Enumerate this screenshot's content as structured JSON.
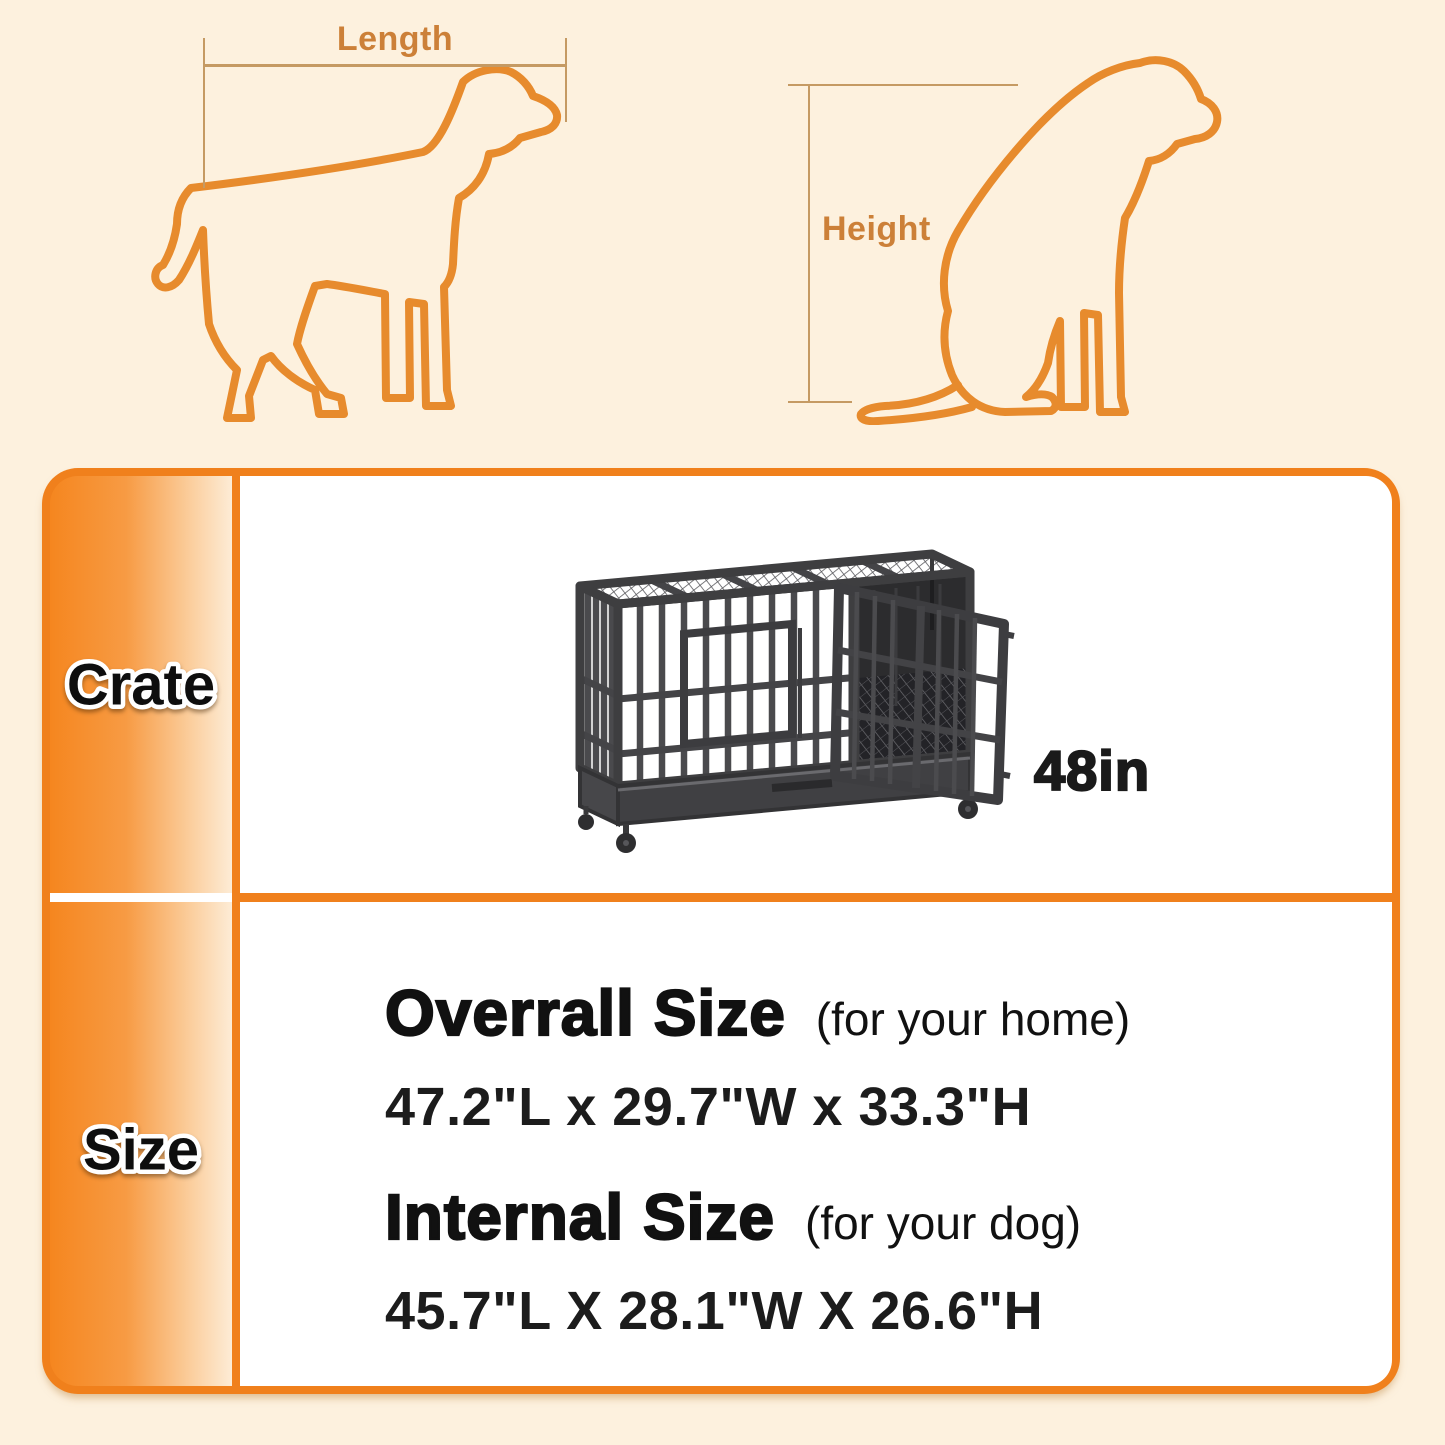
{
  "page": {
    "background": "#fdf1de",
    "accent_orange": "#f0801c",
    "dog_outline_color": "#e78b2d",
    "measure_line_color": "#c59a63"
  },
  "measure_diagram": {
    "length_label": "Length",
    "height_label": "Height"
  },
  "spec_table": {
    "rows": [
      {
        "header": "Crate"
      },
      {
        "header": "Size"
      }
    ],
    "crate_cell": {
      "size_label": "48in"
    },
    "size_cell": {
      "overall": {
        "title": "Overrall Size",
        "note": "(for your home)",
        "dimensions": "47.2\"L x 29.7\"W x 33.3\"H"
      },
      "internal": {
        "title": "Internal Size",
        "note": "(for your dog)",
        "dimensions": "45.7\"L X 28.1\"W X 26.6\"H"
      }
    }
  }
}
